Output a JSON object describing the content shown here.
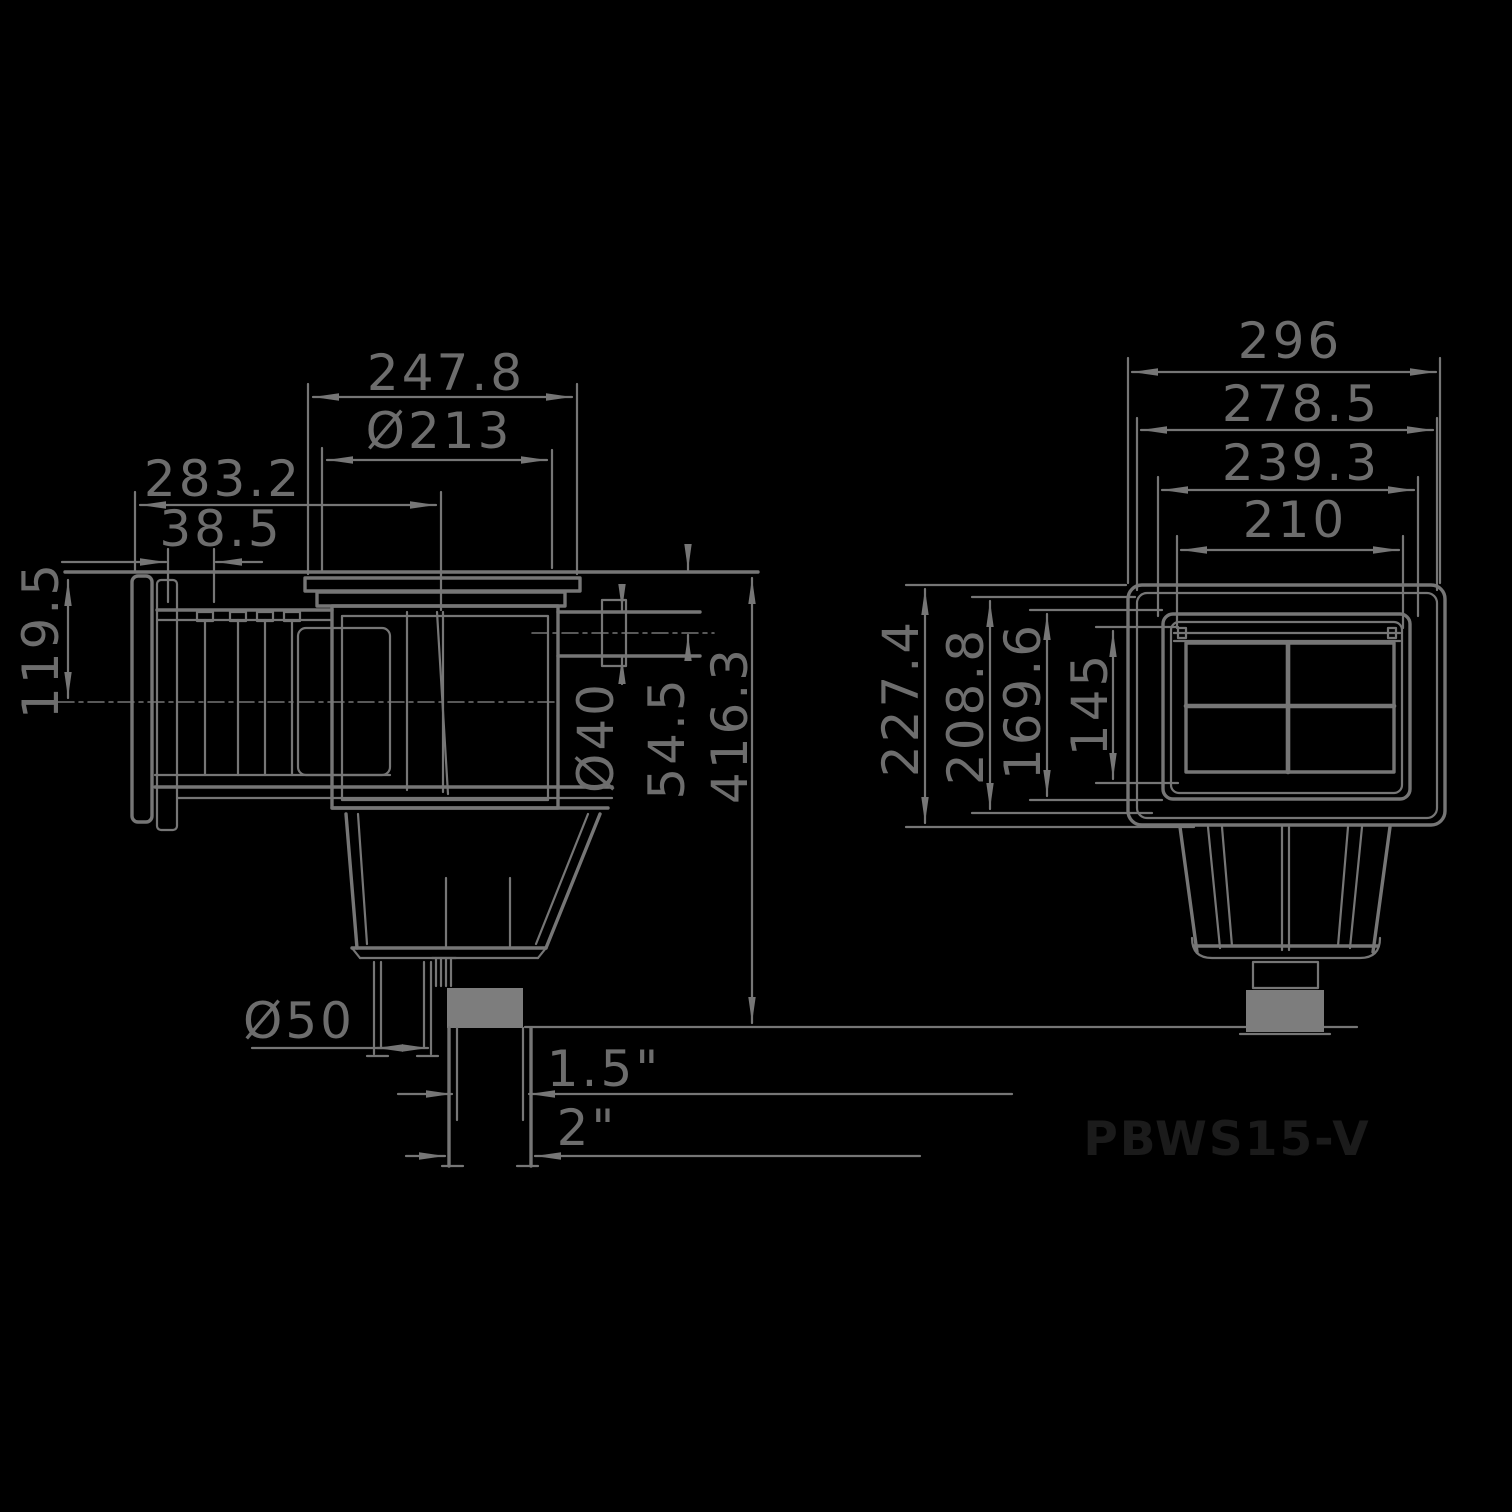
{
  "side_view": {
    "top_width": "247.8",
    "lid_diameter": "Ø213",
    "throat_depth": "283.2",
    "flange_width": "38.5",
    "faceplate_height": "119.5",
    "inlet_diameter": "Ø40",
    "inlet_offset": "54.5",
    "total_height": "416.3",
    "drain_diameter": "Ø50",
    "thread_inner": "1.5\"",
    "thread_outer": "2\""
  },
  "front_view": {
    "width_outer": "296",
    "width_mid": "278.5",
    "width_inner": "239.3",
    "width_opening": "210",
    "height_outer": "227.4",
    "height_mid": "208.8",
    "height_inner": "169.6",
    "height_opening": "145"
  },
  "model_label": "PBWS15-V",
  "colors": {
    "background": "#000000",
    "line": "#767676",
    "dim_text": "#6d6d6d",
    "model_text": "#1b1b1b",
    "block_fill": "#7d7d7d"
  }
}
